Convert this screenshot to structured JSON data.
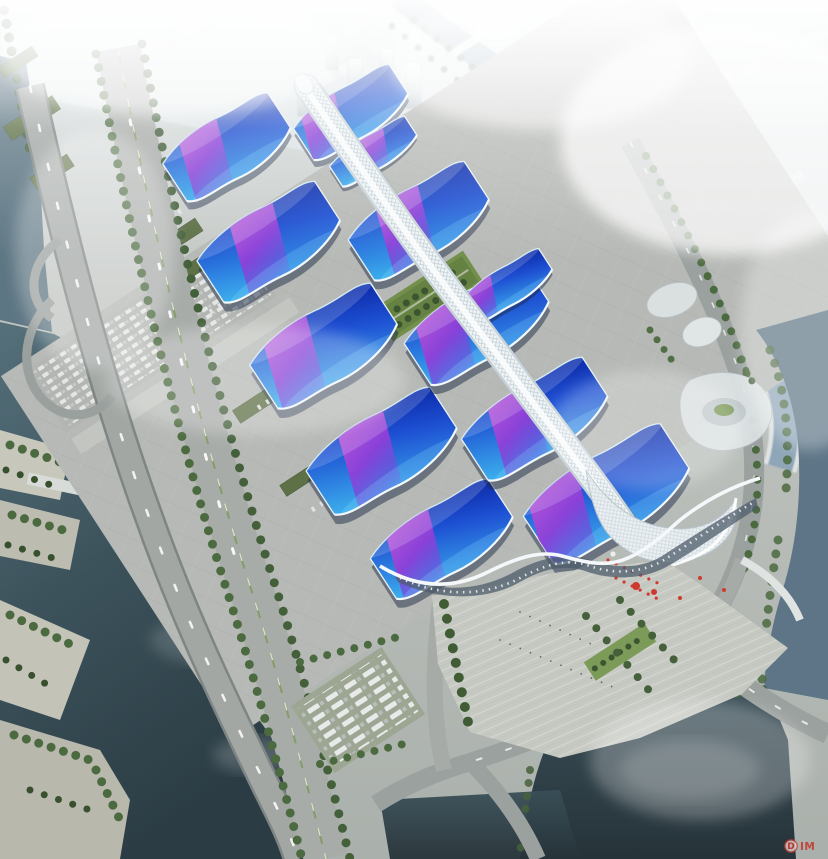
{
  "scene": {
    "subject": "aerial-rendering-exhibition-center",
    "region_labels": [
      "hazy city skyline",
      "winding canal",
      "riverside highway",
      "exhibition halls with wavy blue roofs and purple ribbons",
      "white central pedestrian spine",
      "south entrance plaza with palm trees and red flags",
      "dark ponds and river",
      "parking lots"
    ]
  },
  "palette": {
    "roof_cyan": "#3fb6ec",
    "roof_blue": "#1d4fd2",
    "roof_deep": "#0e2fae",
    "ribbon_magenta": "#bb4fd8",
    "ribbon_violet": "#6a52dc",
    "spine_white": "#eef4f6",
    "water_dark": "#2e3f47",
    "canal_blue": "#8fa6b8",
    "ground_gray": "#b6b9b5",
    "tree_green": "#4c6a40",
    "flag_red": "#cf3a2e",
    "haze_white": "#f2f6f7"
  },
  "halls": [
    {
      "id": "west-1",
      "cx": 228,
      "cy": 148,
      "w": 132,
      "h": 74,
      "rot": -33,
      "rx": -2
    },
    {
      "id": "west-2",
      "cx": 270,
      "cy": 243,
      "w": 148,
      "h": 82,
      "rot": -33,
      "rx": 10
    },
    {
      "id": "west-3",
      "cx": 325,
      "cy": 347,
      "w": 152,
      "h": 86,
      "rot": -33,
      "rx": -6
    },
    {
      "id": "west-4",
      "cx": 383,
      "cy": 452,
      "w": 156,
      "h": 86,
      "rot": -33,
      "rx": 8
    },
    {
      "id": "west-5",
      "cx": 443,
      "cy": 540,
      "w": 148,
      "h": 80,
      "rot": -33,
      "rx": -4
    },
    {
      "id": "east-1",
      "cx": 352,
      "cy": 113,
      "w": 120,
      "h": 62,
      "rot": -33,
      "rx": -10
    },
    {
      "id": "east-1b",
      "cx": 374,
      "cy": 152,
      "w": 94,
      "h": 40,
      "rot": -33,
      "rx": 16
    },
    {
      "id": "east-2",
      "cx": 420,
      "cy": 222,
      "w": 146,
      "h": 80,
      "rot": -33,
      "rx": 6
    },
    {
      "id": "east-3",
      "cx": 478,
      "cy": 325,
      "w": 150,
      "h": 82,
      "rot": -33,
      "rx": -8
    },
    {
      "id": "east-3b",
      "cx": 508,
      "cy": 286,
      "w": 96,
      "h": 44,
      "rot": -33,
      "rx": -16
    },
    {
      "id": "east-4",
      "cx": 536,
      "cy": 420,
      "w": 152,
      "h": 82,
      "rot": -33,
      "rx": 4
    },
    {
      "id": "east-5",
      "cx": 608,
      "cy": 495,
      "w": 172,
      "h": 94,
      "rot": -33,
      "rx": -14
    }
  ],
  "courtyard": {
    "cx": 428,
    "cy": 296,
    "w": 108,
    "h": 38,
    "rot": -33
  },
  "watermark": {
    "letter": "D",
    "text": "IM",
    "color": "#c43b30"
  }
}
